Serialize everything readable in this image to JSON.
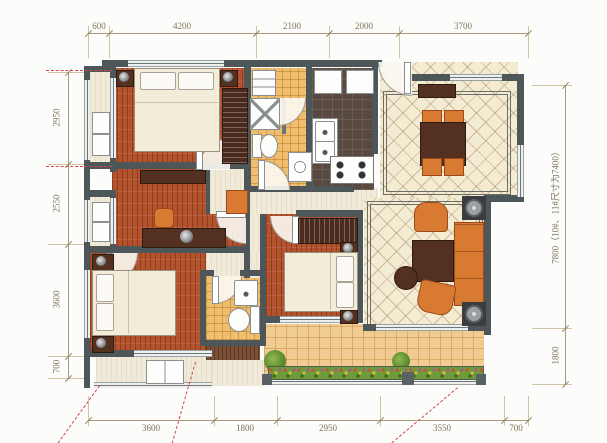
{
  "plan": {
    "type": "apartment-floor-plan"
  },
  "dimensions": {
    "top": [
      "600",
      "4200",
      "2100",
      "2000",
      "3700"
    ],
    "bottom": [
      "3600",
      "1800",
      "2950",
      "3550",
      "700"
    ],
    "left": [
      "2950",
      "2550",
      "3600",
      "700"
    ],
    "right": [
      "7800（10#、11#尺寸为7400）",
      "1800"
    ]
  },
  "colors": {
    "wall": "#4d575a",
    "wood_floor": "#b2532e",
    "bath_tile": "#eebd6e",
    "kitchen_floor": "#584941",
    "hall_tile": "#f4ebd3",
    "balcony_tile": "#f0cb92",
    "furniture_dark": "#53301f",
    "furniture_orange": "#d97a33",
    "dimension_text": "#7f7257",
    "projection_line": "#d2484a"
  }
}
